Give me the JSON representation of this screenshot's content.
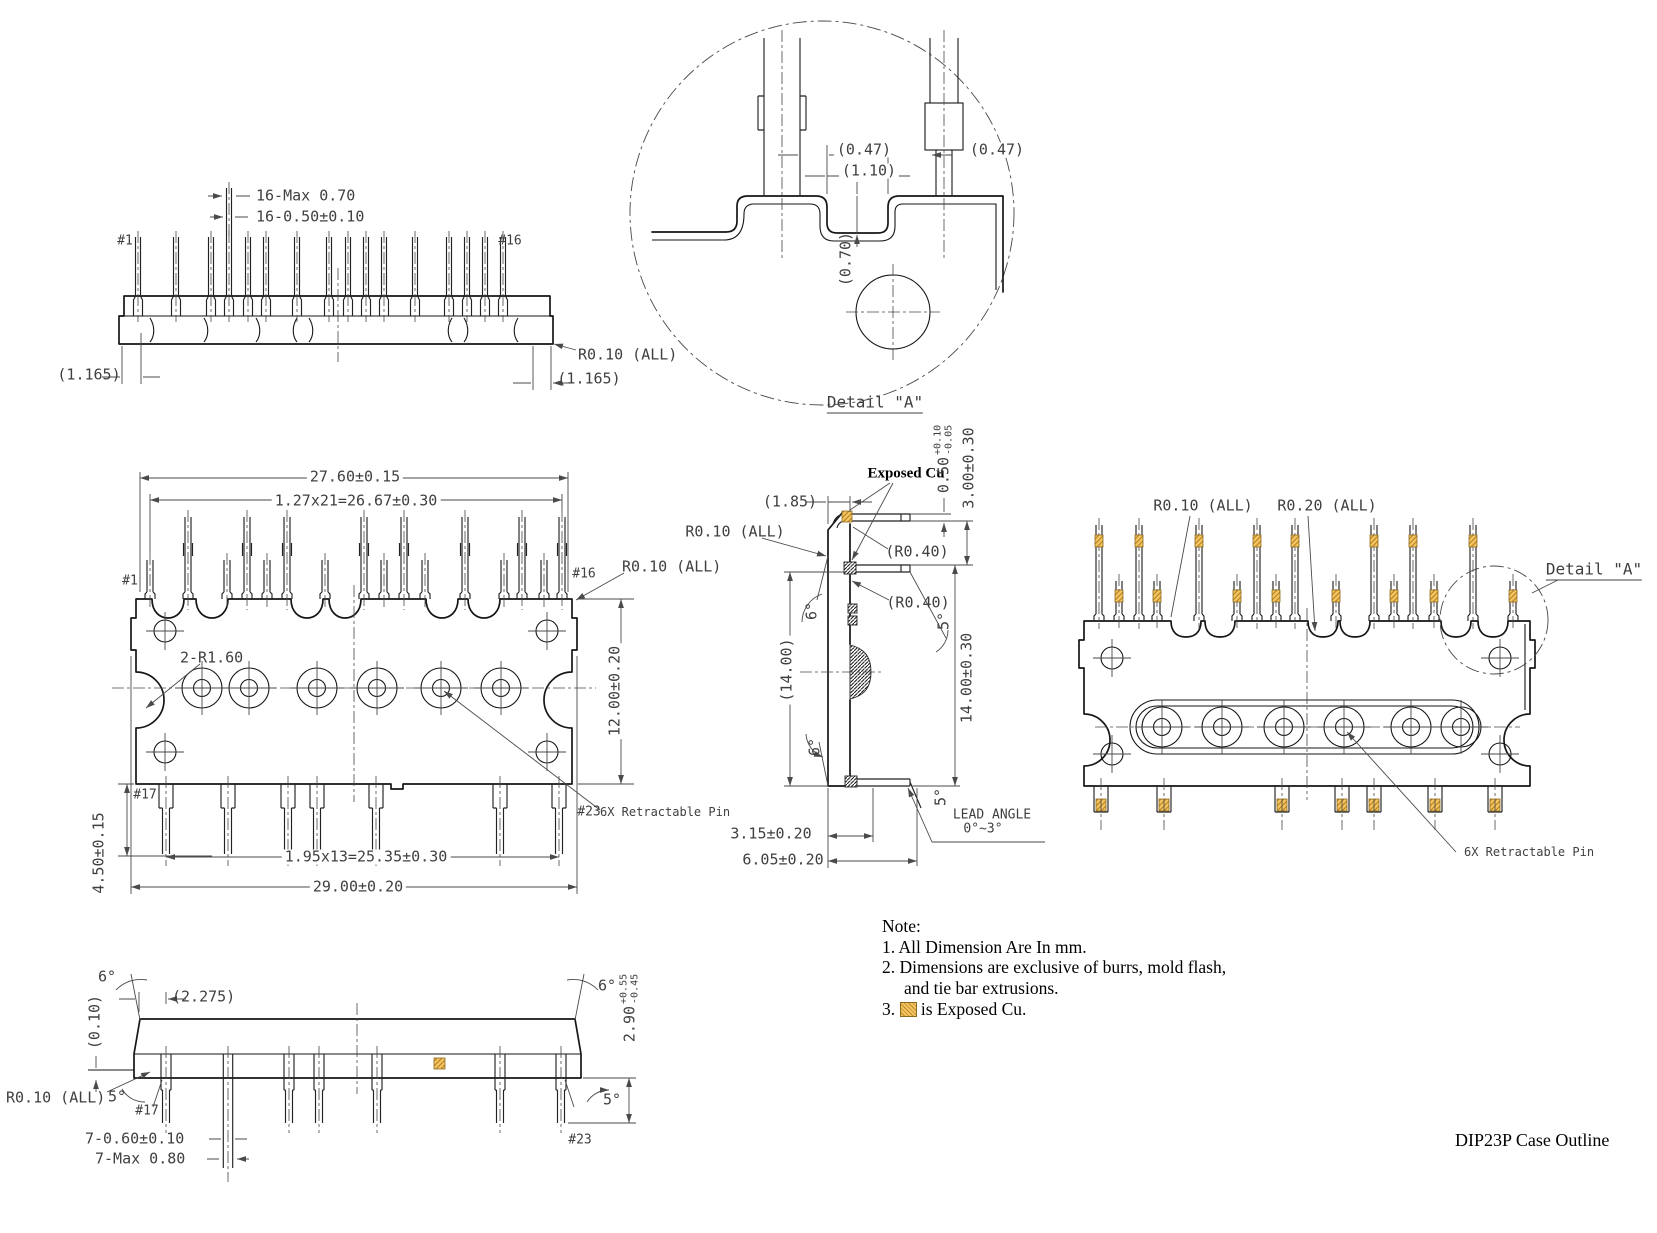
{
  "title": "DIP23P Case Outline",
  "colors": {
    "exposed_cu": "#f2c55e",
    "cu_hatch": "#b97f28",
    "object_line": "#161616",
    "dim_line": "#4a4a4a"
  },
  "notes": {
    "heading": "Note:",
    "line1": "1. All Dimension Are In mm.",
    "line2": "2. Dimensions are exclusive of burrs, mold flash,",
    "line3": "and tie bar extrusions.",
    "line4_prefix": "3.",
    "line4_suffix": "is Exposed Cu."
  },
  "top_view": {
    "dim_pin_max": "16-Max 0.70",
    "dim_pin": "16-0.50±0.10",
    "pin_first": "#1",
    "pin_last": "#16",
    "radius_all": "R0.10 (ALL)",
    "offset_left": "(1.165)",
    "offset_right": "(1.165)"
  },
  "detail_a": {
    "label": "Detail \"A\"",
    "dim_left": "(0.47)",
    "dim_pitch": "(1.10)",
    "dim_right": "(0.47)",
    "dim_depth": "(0.70)"
  },
  "front_view": {
    "dim_body_width": "27.60±0.15",
    "dim_pitch_top": "1.27x21=26.67±0.30",
    "pin_first": "#1",
    "pin_last": "#16",
    "radius_all": "R0.10 (ALL)",
    "dim_corner_radius": "2-R1.60",
    "dim_height": "12.00±0.20",
    "pin_17": "#17",
    "pin_23": "#23",
    "dim_pitch_bottom": "1.95x13=25.35±0.30",
    "dim_total_width": "29.00±0.20",
    "dim_pin_length": "4.50±0.15",
    "retractable_pin": "6X Retractable Pin"
  },
  "side_view": {
    "exposed_cu": "Exposed Cu",
    "dim_cu_thickness": {
      "base": "0.50",
      "plus": "+0.10",
      "minus": "-0.05"
    },
    "dim_lead_offset": "3.00±0.30",
    "dim_body_depth": "(1.85)",
    "radius_all": "R0.10 (ALL)",
    "radius_bend_top": "(R0.40)",
    "radius_bend_bottom": "(R0.40)",
    "angle_top_front": "6°",
    "angle_top_back": "5°",
    "angle_bottom_front": "6°",
    "angle_bottom_back": "5°",
    "dim_height_ref": "(14.00)",
    "dim_height": "14.00±0.30",
    "lead_angle_label": "LEAD ANGLE",
    "lead_angle_range": "0°~3°",
    "dim_standoff_1": "3.15±0.20",
    "dim_standoff_2": "6.05±0.20"
  },
  "back_view": {
    "radius_r010": "R0.10 (ALL)",
    "radius_r020": "R0.20 (ALL)",
    "detail_ref": "Detail \"A\"",
    "retractable_pin": "6X Retractable Pin"
  },
  "bottom_view": {
    "angle_end_left": "6°",
    "angle_end_right": "6°",
    "angle_pin_left": "5°",
    "angle_pin_right": "5°",
    "dim_pin_offset": "(2.275)",
    "dim_standoff": "(0.10)",
    "radius_all": "R0.10 (ALL)",
    "pin_17": "#17",
    "pin_23": "#23",
    "dim_pin_width": "7-0.60±0.10",
    "dim_pin_width_max": "7-Max 0.80",
    "dim_protrusion": {
      "base": "2.90",
      "plus": "+0.55",
      "minus": "-0.45"
    }
  }
}
